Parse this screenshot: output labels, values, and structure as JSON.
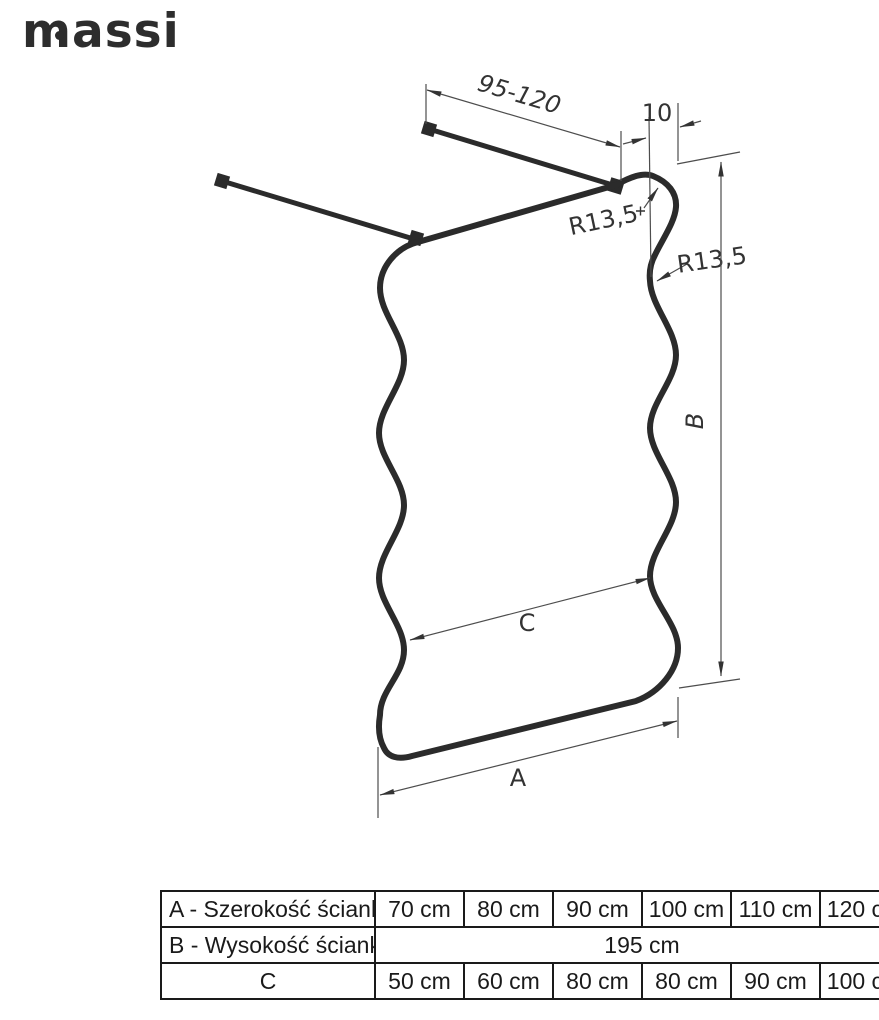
{
  "brand": {
    "name": "massi"
  },
  "diagram": {
    "labels": {
      "bar_length": "95-120",
      "edge_offset": "10",
      "radius_corner": "R13,5",
      "radius_wave": "R13,5",
      "height": "B",
      "waist_width": "C",
      "width": "A"
    }
  },
  "table": {
    "rows": [
      {
        "label": "A - Szerokość ścianki",
        "values": [
          "70 cm",
          "80 cm",
          "90 cm",
          "100 cm",
          "110 cm",
          "120 cm"
        ]
      },
      {
        "label": "B - Wysokość ścianki",
        "merged_value": "195 cm"
      },
      {
        "label": "C",
        "values": [
          "50 cm",
          "60 cm",
          "80 cm",
          "80 cm",
          "90 cm",
          "100 cm"
        ]
      }
    ]
  }
}
